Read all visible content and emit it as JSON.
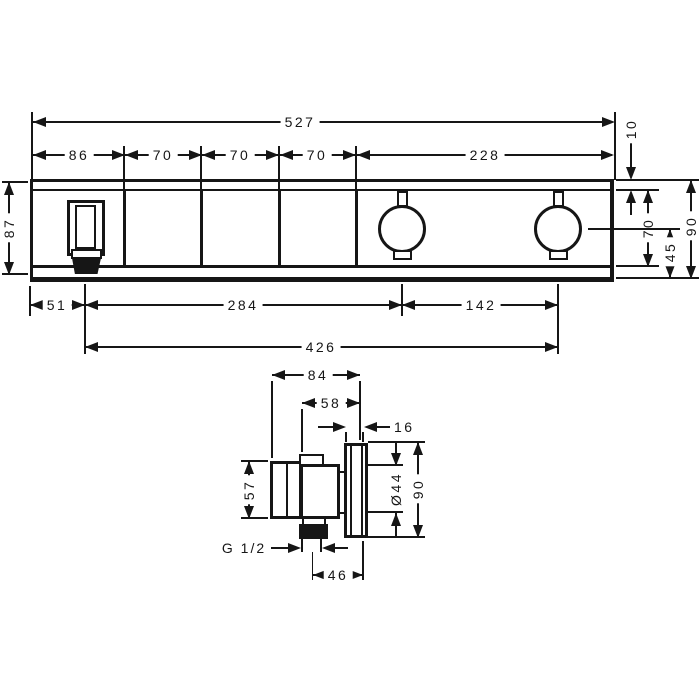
{
  "drawing": {
    "type": "installation-dimension-drawing",
    "views": {
      "front": "front view",
      "side": "side view"
    },
    "colors": {
      "ink": "#161616",
      "background": "#ffffff"
    }
  },
  "front_view": {
    "dims": {
      "total_width": "527",
      "seg1": "86",
      "seg2": "70",
      "seg3": "70",
      "seg4": "70",
      "seg5": "228",
      "top_edge": "10",
      "left_height": "87",
      "right_opening": "70",
      "right_total": "90",
      "right_lower": "45",
      "spout_offset": "51",
      "spout_to_handle": "284",
      "handle_spacing": "142",
      "bottom_total": "426"
    }
  },
  "side_view": {
    "dims": {
      "total_depth": "84",
      "body_depth": "58",
      "escutcheon_depth": "16",
      "handle_height": "57",
      "bore_diameter": "Ø44",
      "escutcheon_height": "90",
      "thread": "G 1/2",
      "axis_to_face": "46"
    }
  }
}
